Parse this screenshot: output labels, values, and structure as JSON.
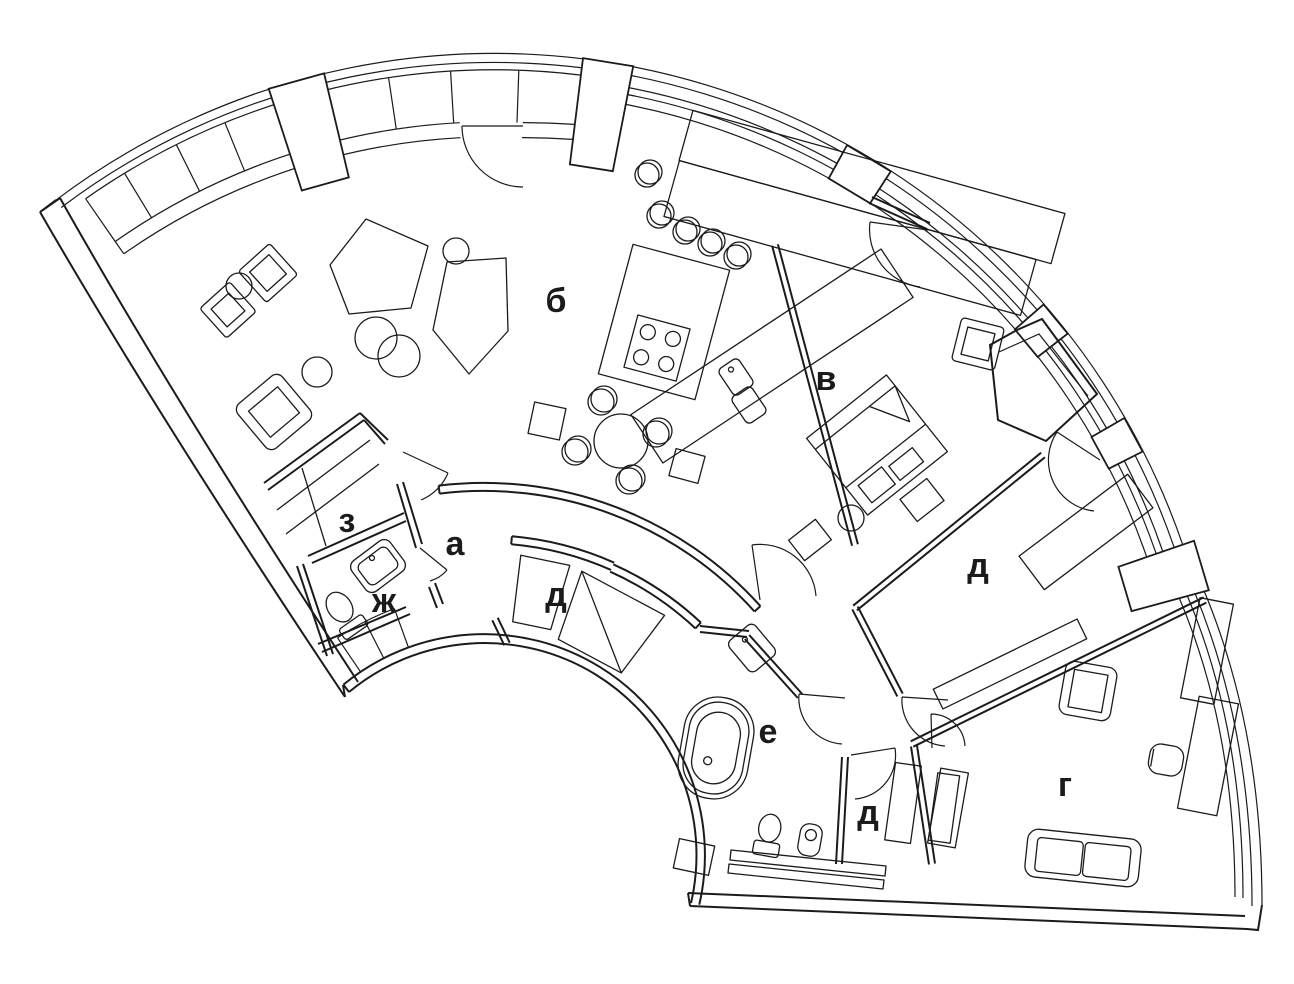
{
  "plan": {
    "background": "#ffffff",
    "line_color": "#1b1b1b",
    "rooms": [
      {
        "id": "a",
        "label": "а"
      },
      {
        "id": "b",
        "label": "б"
      },
      {
        "id": "v",
        "label": "в"
      },
      {
        "id": "g",
        "label": "г"
      },
      {
        "id": "d1",
        "label": "д"
      },
      {
        "id": "d2",
        "label": "д"
      },
      {
        "id": "d3",
        "label": "д"
      },
      {
        "id": "e",
        "label": "е"
      },
      {
        "id": "zh",
        "label": "ж"
      },
      {
        "id": "z",
        "label": "з"
      }
    ]
  }
}
